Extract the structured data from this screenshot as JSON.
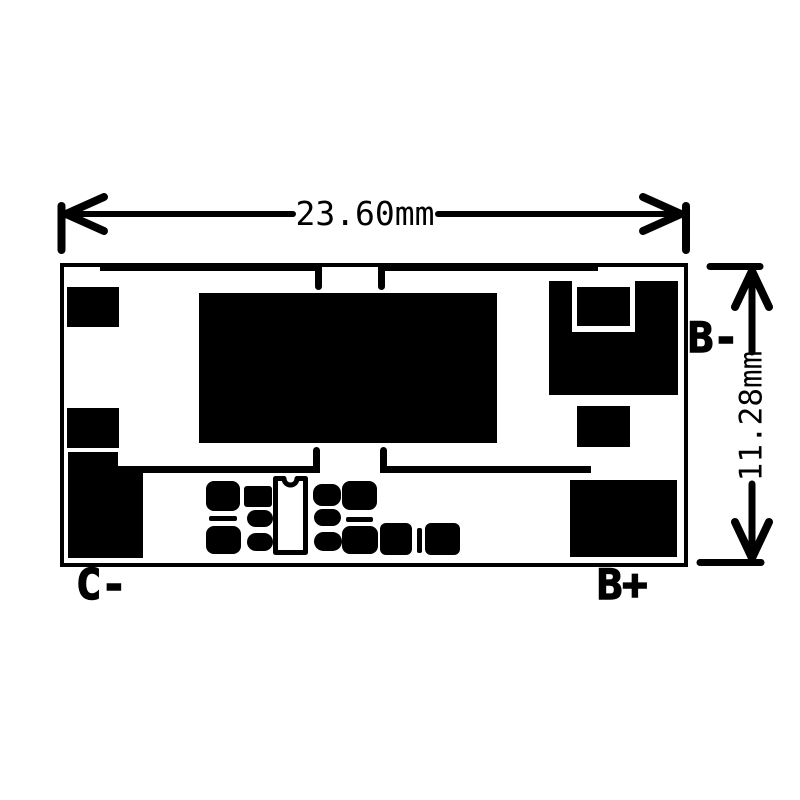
{
  "diagram": {
    "type": "pcb-dimension-drawing",
    "width_dim_label": "23.60mm",
    "height_dim_label": "11.28mm",
    "terminals": {
      "b_minus": "B-",
      "c_minus": "C-",
      "b_plus": "B+"
    },
    "colors": {
      "ink": "#000000",
      "background": "#ffffff"
    }
  }
}
